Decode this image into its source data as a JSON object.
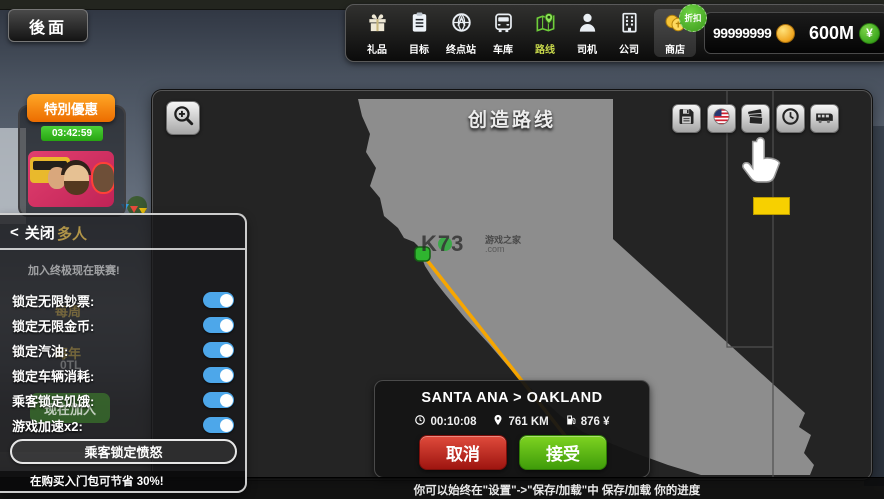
{
  "back_button": "後面",
  "top_nav": {
    "items": [
      {
        "id": "gifts",
        "label": "礼品",
        "icon": "gift-icon"
      },
      {
        "id": "goals",
        "label": "目标",
        "icon": "clipboard-icon"
      },
      {
        "id": "terminal",
        "label": "终点站",
        "icon": "globe-icon"
      },
      {
        "id": "garage",
        "label": "车库",
        "icon": "bus-front-icon"
      },
      {
        "id": "routes",
        "label": "路线",
        "icon": "route-map-icon",
        "active": true
      },
      {
        "id": "drivers",
        "label": "司机",
        "icon": "driver-icon"
      },
      {
        "id": "company",
        "label": "公司",
        "icon": "building-icon"
      },
      {
        "id": "shop",
        "label": "商店",
        "icon": "coins-icon",
        "badge": "折扣"
      }
    ],
    "discount_badge": "折扣",
    "coins_amount": "99999999",
    "cash_amount": "600M",
    "cash_symbol": "¥"
  },
  "special_offer": {
    "title": "特別優惠",
    "countdown": "03:42:59"
  },
  "multiplayer_panel": {
    "chevron": "<",
    "close_label": "关闭",
    "title": "多人",
    "banner": "加入终极现在联赛!",
    "toggles": [
      {
        "label": "锁定无限钞票:",
        "state": "on"
      },
      {
        "label": "锁定无限金币:",
        "state": "on"
      },
      {
        "label": "锁定汽油:",
        "state": "on"
      },
      {
        "label": "锁定车辆消耗:",
        "state": "on"
      },
      {
        "label": "乘客锁定饥饿:",
        "state": "on"
      },
      {
        "label": "游戏加速x2:",
        "state": "on"
      }
    ],
    "anger_button": "乘客锁定愤怒",
    "promo": "在购买入门包可节省 30%!",
    "faint_background": {
      "weekly": "每周",
      "per_year": "每年",
      "price": "0TL",
      "join_now": "现在加入"
    }
  },
  "map_panel": {
    "title": "创造路线",
    "watermark": {
      "logo": "K73",
      "site_name": "游戏之家",
      "domain": ".com"
    },
    "route_card": {
      "title": "SANTA ANA > OAKLAND",
      "time": "00:10:08",
      "distance": "761 KM",
      "fuel_cost": "876 ¥",
      "cancel_label": "取消",
      "accept_label": "接受"
    }
  },
  "bottom_bar": {
    "hint": "你可以始终在\"设置\"->\"保存/加载\"中 保存/加载 你的进度"
  },
  "colors": {
    "toggle_on": "#4da7ea",
    "accept_green": "#4db81e",
    "cancel_red": "#c4271f",
    "route_orange": "#f7a600",
    "offer_orange": "#f08200",
    "timer_green": "#2eb62c",
    "coin_gold": "#f2b632",
    "active_tab_label": "#c6d64b"
  }
}
